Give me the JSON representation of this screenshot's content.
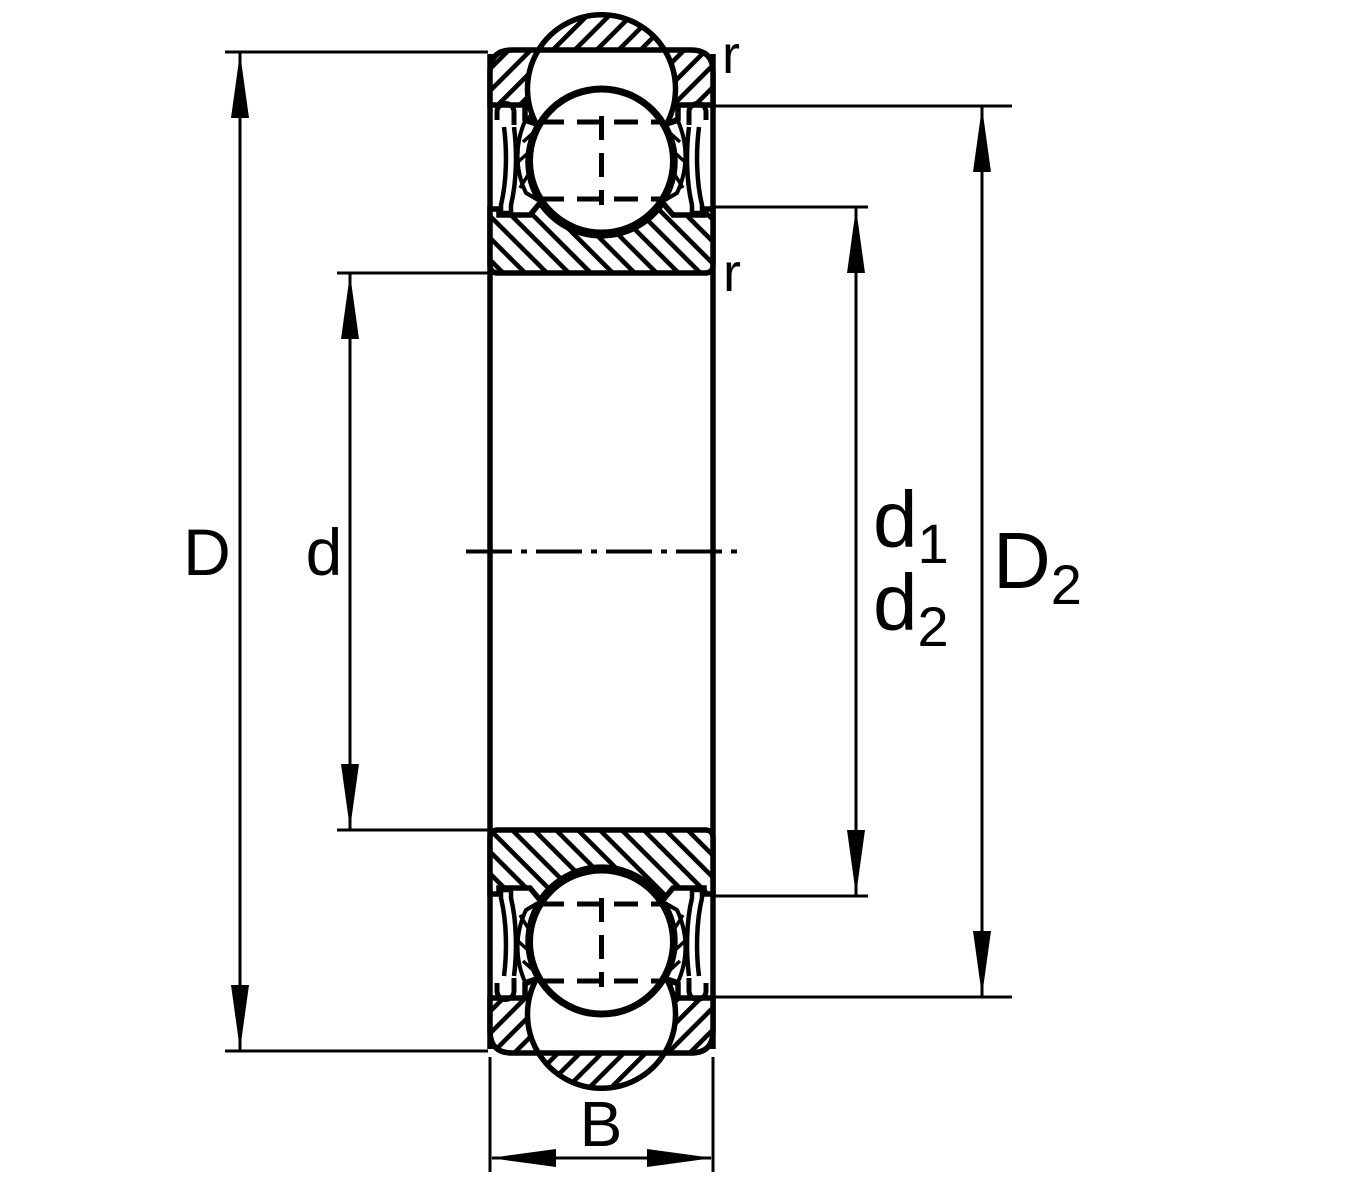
{
  "drawing": {
    "type": "bearing-cross-section-dimension-drawing",
    "labels": {
      "D": "D",
      "d": "d",
      "B": "B",
      "d1_base": "d",
      "d1_sub": "1",
      "d2_base": "d",
      "d2_sub": "2",
      "D2_base": "D",
      "D2_sub": "2",
      "r_top": "r",
      "r_inner": "r"
    },
    "colors": {
      "stroke": "#000000",
      "background": "#ffffff"
    }
  }
}
